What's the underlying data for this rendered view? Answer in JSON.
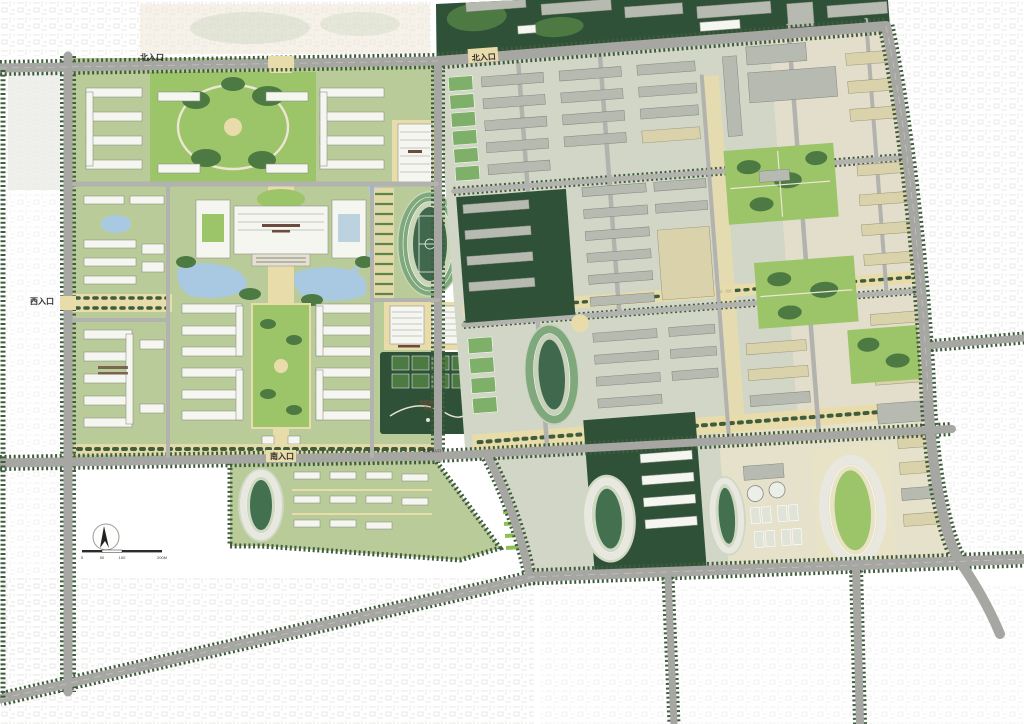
{
  "map": {
    "entrances": {
      "north_left": "北入口",
      "north_right": "北入口",
      "west": "西入口",
      "south": "南入口",
      "service": "机动车入口"
    },
    "annotations": {
      "reserved_land_line1": "预留发展",
      "reserved_land_line2": "用地"
    },
    "scale_bar": {
      "tick0": "0",
      "tick1": "50",
      "tick2": "100",
      "tick3": "200M"
    },
    "colors": {
      "road": "#a6a6a3",
      "roadMinor": "#b2b2ae",
      "treeline": "#3f5c3c",
      "lawn": "#b8cb99",
      "lawnBright": "#9cc468",
      "woods": "#2f5137",
      "woodsLight": "#4c7a42",
      "bldgWhite": "#f6f6f1",
      "bldgEdge": "#8f928a",
      "bldgGray": "#b7bab0",
      "bldgTan": "#d9d2ab",
      "plaza": "#e9dcab",
      "water": "#a9c9e2",
      "track": "#7fa87c",
      "infield": "#40684d",
      "courtGreen": "#7fb069",
      "labelDark": "#2e2d2b",
      "reservedInk": "#8a4a33",
      "scaleInk": "#3a3a38"
    }
  }
}
